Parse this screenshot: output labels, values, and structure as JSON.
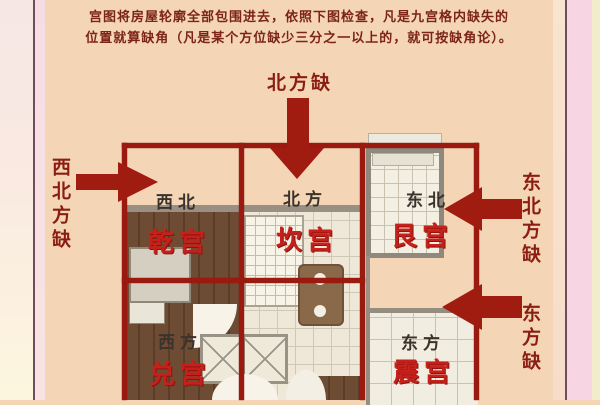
{
  "header": {
    "line1": "宫图将房屋轮廓全部包围进去，依照下图检查，凡是九宫格内缺失的",
    "line2": "位置就算缺角（凡是某个方位缺少三分之一以上的，就可按缺角论）。"
  },
  "diagram": {
    "outside_labels": {
      "north": "北方缺",
      "northwest": "西北方缺",
      "northeast": "东北方缺",
      "east": "东方缺"
    },
    "cells": [
      {
        "direction": "西北",
        "palace": "乾宫"
      },
      {
        "direction": "北方",
        "palace": "坎宫"
      },
      {
        "direction": "东北",
        "palace": "艮宫"
      },
      {
        "direction": "西方",
        "palace": "兑宫"
      },
      {
        "direction": "东方",
        "palace": "震宫"
      }
    ],
    "colors": {
      "grid_line": "#9b1a10",
      "arrow": "#a01b10",
      "palace_text": "#c6201a",
      "direction_text": "#3a332c",
      "outside_label_text": "#8a1e12",
      "background": "#f4d5b6"
    }
  }
}
